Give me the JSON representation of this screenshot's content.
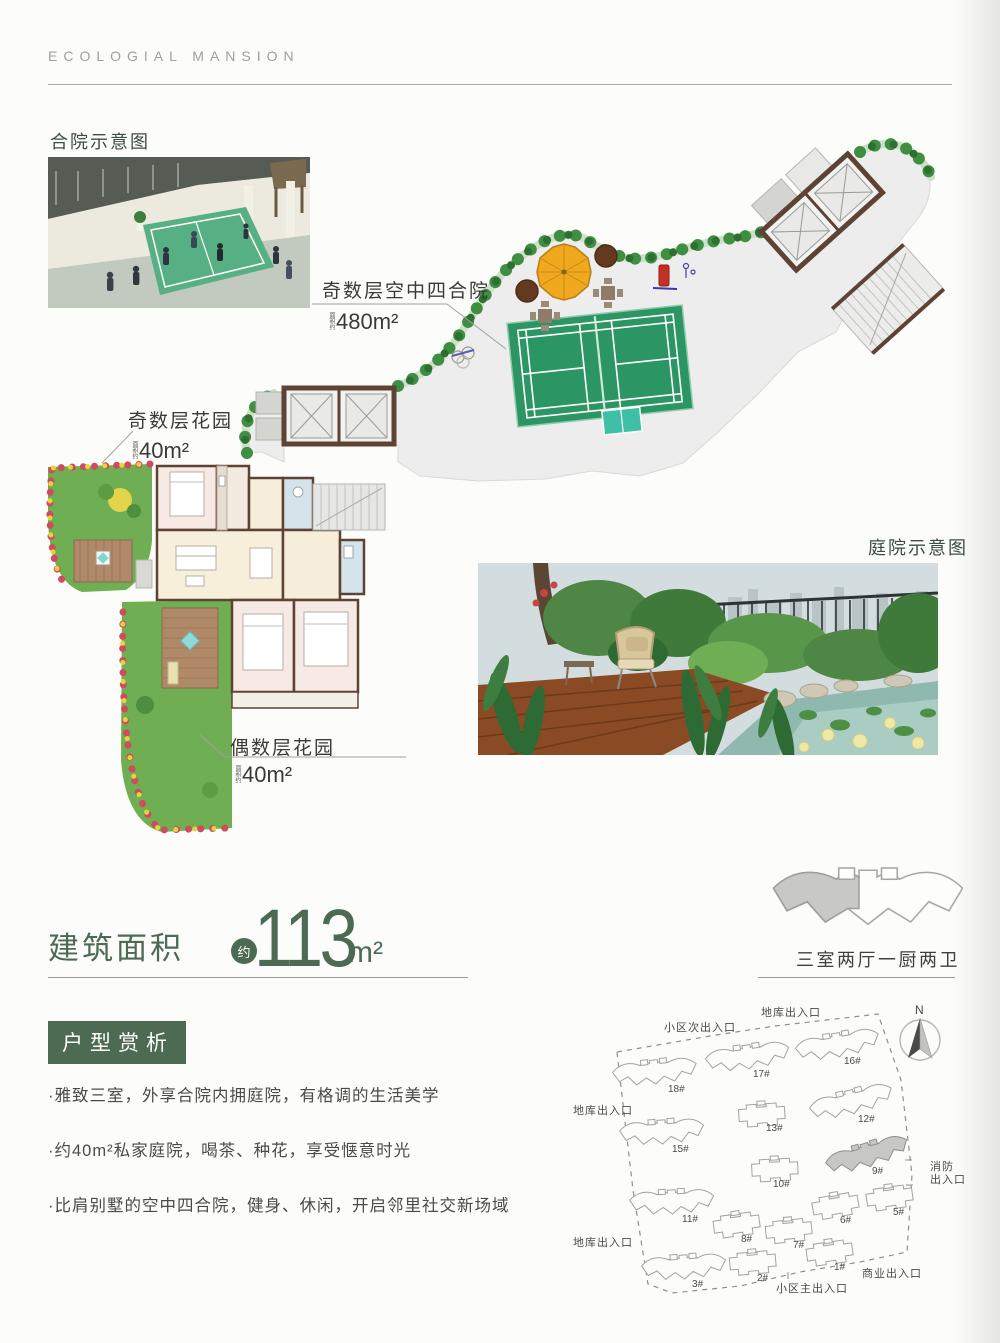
{
  "page": {
    "brand": "ECOLOGIAL  MANSION"
  },
  "plan": {
    "photo1_label": "合院示意图",
    "photo2_label": "庭院示意图",
    "sky_courtyard": {
      "name": "奇数层空中四合院",
      "area_prefix": "面积约",
      "area": "480m²"
    },
    "odd_garden": {
      "name": "奇数层花园",
      "area_prefix": "面积约",
      "area": "40m²"
    },
    "even_garden": {
      "name": "偶数层花园",
      "area_prefix": "面积约",
      "area": "40m²"
    }
  },
  "area_section": {
    "label": "建筑面积",
    "approx": "约",
    "value": "113",
    "unit": "m²",
    "layout": "三室两厅一厨两卫"
  },
  "analysis": {
    "title": "户型赏析",
    "bullets": [
      "·雅致三室，外享合院内拥庭院，有格调的生活美学",
      "·约40m²私家庭院，喝茶、种花，享受惬意时光",
      "·比肩别墅的空中四合院，健身、休闲，开启邻里社交新场域"
    ]
  },
  "siteplan": {
    "north_label": "N",
    "buildings": [
      {
        "label": "18#",
        "x": 655,
        "y": 1075,
        "rot": -6,
        "type": "A",
        "hl": false,
        "lx": 668,
        "ly": 1092
      },
      {
        "label": "17#",
        "x": 748,
        "y": 1060,
        "rot": -8,
        "type": "A",
        "hl": false,
        "lx": 753,
        "ly": 1077
      },
      {
        "label": "16#",
        "x": 838,
        "y": 1048,
        "rot": -10,
        "type": "A",
        "hl": false,
        "lx": 844,
        "ly": 1064
      },
      {
        "label": "15#",
        "x": 662,
        "y": 1135,
        "rot": -4,
        "type": "A",
        "hl": false,
        "lx": 672,
        "ly": 1152
      },
      {
        "label": "13#",
        "x": 762,
        "y": 1117,
        "rot": -4,
        "type": "B",
        "hl": false,
        "lx": 766,
        "ly": 1131
      },
      {
        "label": "12#",
        "x": 852,
        "y": 1105,
        "rot": -14,
        "type": "A",
        "hl": false,
        "lx": 858,
        "ly": 1122
      },
      {
        "label": "9#",
        "x": 868,
        "y": 1158,
        "rot": -16,
        "type": "A",
        "hl": true,
        "lx": 872,
        "ly": 1174
      },
      {
        "label": "10#",
        "x": 775,
        "y": 1172,
        "rot": -3,
        "type": "B",
        "hl": false,
        "lx": 773,
        "ly": 1187
      },
      {
        "label": "11#",
        "x": 672,
        "y": 1205,
        "rot": -3,
        "type": "A",
        "hl": false,
        "lx": 682,
        "ly": 1222
      },
      {
        "label": "8#",
        "x": 737,
        "y": 1227,
        "rot": -8,
        "type": "B",
        "hl": false,
        "lx": 741,
        "ly": 1242
      },
      {
        "label": "7#",
        "x": 789,
        "y": 1233,
        "rot": -6,
        "type": "B",
        "hl": false,
        "lx": 793,
        "ly": 1248
      },
      {
        "label": "6#",
        "x": 836,
        "y": 1208,
        "rot": -10,
        "type": "B",
        "hl": false,
        "lx": 840,
        "ly": 1223
      },
      {
        "label": "5#",
        "x": 890,
        "y": 1200,
        "rot": -8,
        "type": "B",
        "hl": false,
        "lx": 893,
        "ly": 1215
      },
      {
        "label": "3#",
        "x": 684,
        "y": 1270,
        "rot": -4,
        "type": "A",
        "hl": false,
        "lx": 692,
        "ly": 1287
      },
      {
        "label": "2#",
        "x": 753,
        "y": 1265,
        "rot": -5,
        "type": "B",
        "hl": false,
        "lx": 757,
        "ly": 1281
      },
      {
        "label": "1#",
        "x": 830,
        "y": 1255,
        "rot": -8,
        "type": "B",
        "hl": false,
        "lx": 834,
        "ly": 1270
      }
    ],
    "entrances": [
      {
        "t": "地库出入口",
        "x": 791,
        "y": 1016,
        "a": "middle"
      },
      {
        "t": "小区次出入口",
        "x": 700,
        "y": 1031,
        "a": "middle"
      },
      {
        "t": "地库出入口",
        "x": 573,
        "y": 1114,
        "a": "start"
      },
      {
        "t": "地库出入口",
        "x": 573,
        "y": 1246,
        "a": "start"
      },
      {
        "t": "消防",
        "x": 930,
        "y": 1170,
        "a": "start"
      },
      {
        "t": "出入口",
        "x": 930,
        "y": 1183,
        "a": "start"
      },
      {
        "t": "商业出入口",
        "x": 862,
        "y": 1277,
        "a": "start"
      },
      {
        "t": "小区主出入口",
        "x": 776,
        "y": 1292,
        "a": "start"
      }
    ]
  },
  "colors": {
    "accent_green": "#4c6b52",
    "badge_green": "#4d6b52",
    "court_green": "#2b9663",
    "deck_gray": "#ecedec",
    "wall_brown": "#5e4334",
    "garden_green": "#6fae52",
    "umbrella_yellow": "#f0a91e",
    "line_gray": "#9b9b97"
  }
}
